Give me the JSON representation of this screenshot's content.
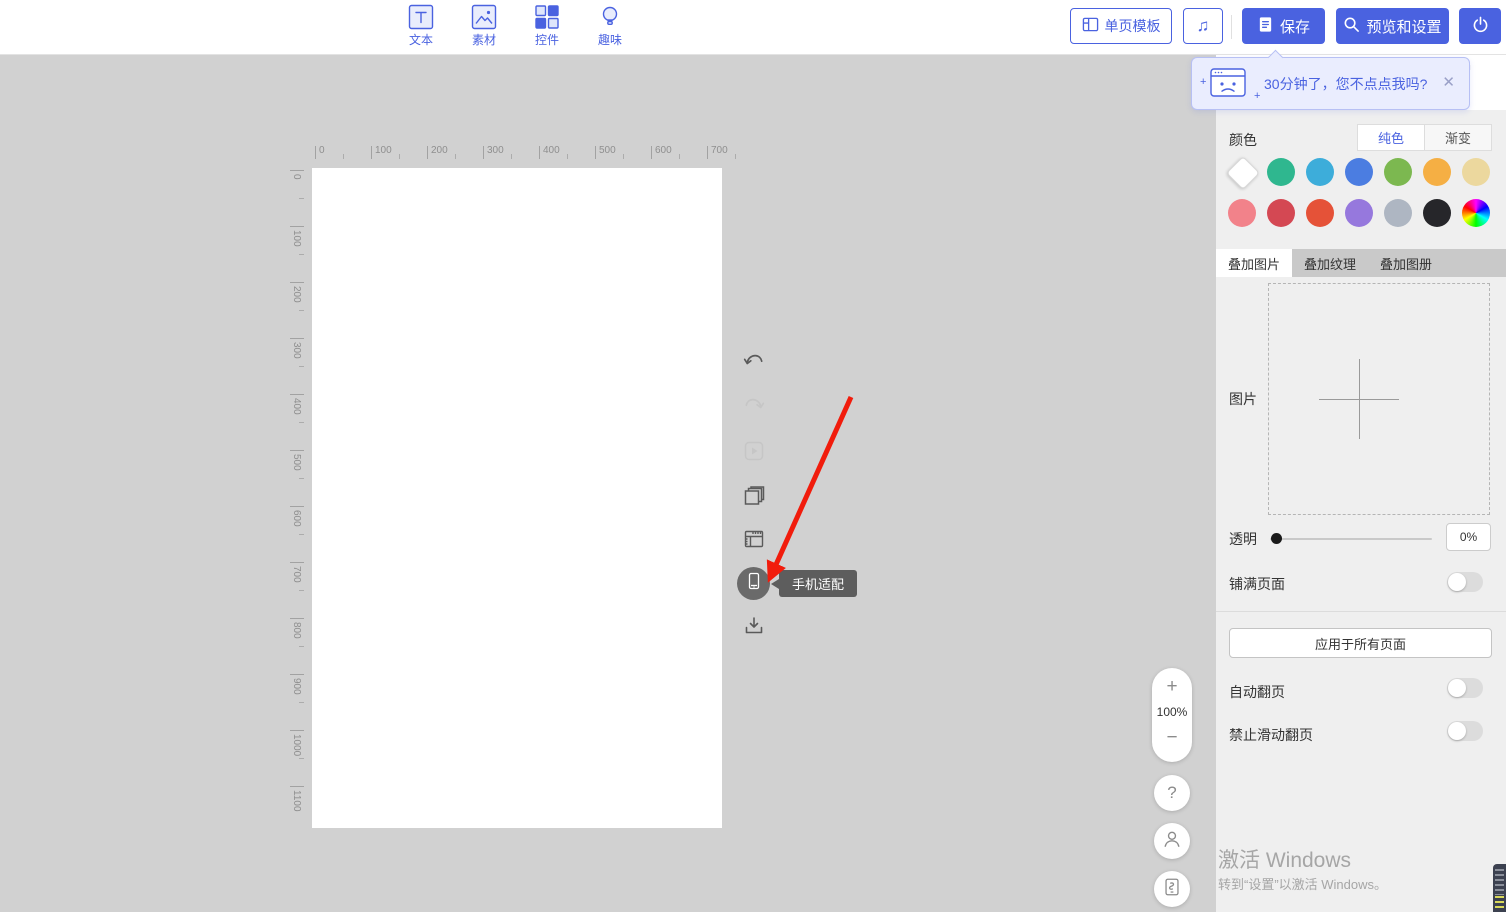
{
  "app": {
    "accent_color": "#4a62e0",
    "workspace_bg": "#d1d1d1",
    "panel_bg": "#efefef",
    "arrow_annotation_color": "#f11c0c"
  },
  "topbar": {
    "tools": [
      {
        "label": "文本"
      },
      {
        "label": "素材"
      },
      {
        "label": "控件"
      },
      {
        "label": "趣味"
      }
    ],
    "template_button": "单页模板",
    "save_button": "保存",
    "preview_button": "预览和设置"
  },
  "notification": {
    "text": "30分钟了，您不点点我吗?"
  },
  "icons": {
    "music": "♫",
    "close": "✕",
    "help": "?",
    "plus_small": "+",
    "zoom_in": "+",
    "zoom_out": "−"
  },
  "canvas": {
    "h_ruler": [
      "0",
      "100",
      "200",
      "300",
      "400",
      "500",
      "600",
      "700"
    ],
    "v_ruler": [
      "0",
      "100",
      "200",
      "300",
      "400",
      "500",
      "600",
      "700",
      "800",
      "900",
      "1000",
      "1100"
    ],
    "zoom_value": "100%"
  },
  "side_toolbar": {
    "tooltip": "手机适配"
  },
  "panel": {
    "color_label": "颜色",
    "solid_tab": "纯色",
    "gradient_tab": "渐变",
    "swatches": [
      "#ffffff",
      "#2fb78f",
      "#3dadda",
      "#4b7de1",
      "#7cb850",
      "#f5af44",
      "#ecd89e",
      "#f2828a",
      "#d44853",
      "#e55238",
      "#9678dd",
      "#aeb6c2",
      "#26262a",
      "conic"
    ],
    "overlay_tabs": [
      "叠加图片",
      "叠加纹理",
      "叠加图册"
    ],
    "image_label": "图片",
    "transparency_label": "透明",
    "transparency_value": "0%",
    "fill_page_label": "铺满页面",
    "apply_all_button": "应用于所有页面",
    "auto_flip_label": "自动翻页",
    "no_swipe_label": "禁止滑动翻页"
  },
  "watermark": {
    "line1": "激活 Windows",
    "line2": "转到“设置”以激活 Windows。"
  }
}
